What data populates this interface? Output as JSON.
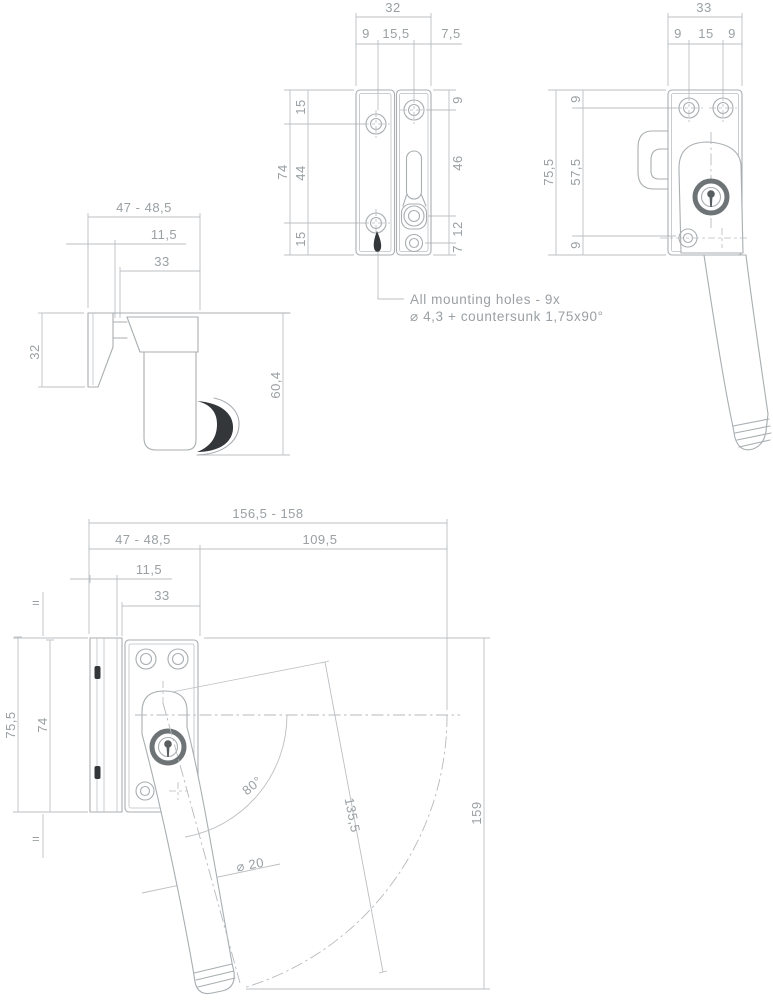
{
  "drawing": {
    "type": "technical-drawing-window-fastener",
    "colors": {
      "background": "#ffffff",
      "line": "#a9aeb1",
      "dimension_line": "#bbbfc2",
      "text": "#9aa0a3",
      "dark_detail": "#33373a",
      "cylinder_ring": "#6e7376"
    }
  },
  "labels": {
    "note1": "All mounting holes - 9x",
    "note2": "⌀ 4,3 + countersunk 1,75x90°",
    "tl": {
      "w": "47 - 48,5",
      "hook": "11,5",
      "base": "33",
      "h": "32",
      "d": "60,4"
    },
    "tm": {
      "w": "32",
      "d1": "9",
      "d2": "15,5",
      "d3": "7,5",
      "h": "74",
      "l1": "15",
      "l2": "44",
      "l3": "15",
      "r1": "9",
      "r2": "46",
      "r3": "12",
      "r4": "7"
    },
    "tr": {
      "w": "33",
      "d1": "9",
      "d2": "15",
      "d3": "9",
      "h": "75,5",
      "h2": "57,5",
      "t": "9",
      "b": "9"
    },
    "bt": {
      "total": "156,5 - 158",
      "w": "47 - 48,5",
      "rspan": "109,5",
      "hook": "11,5",
      "base": "33",
      "h": "75,5",
      "h2": "74",
      "angle": "80°",
      "len": "135,5",
      "th": "159",
      "dia": "⌀ 20",
      "eq": "="
    }
  }
}
